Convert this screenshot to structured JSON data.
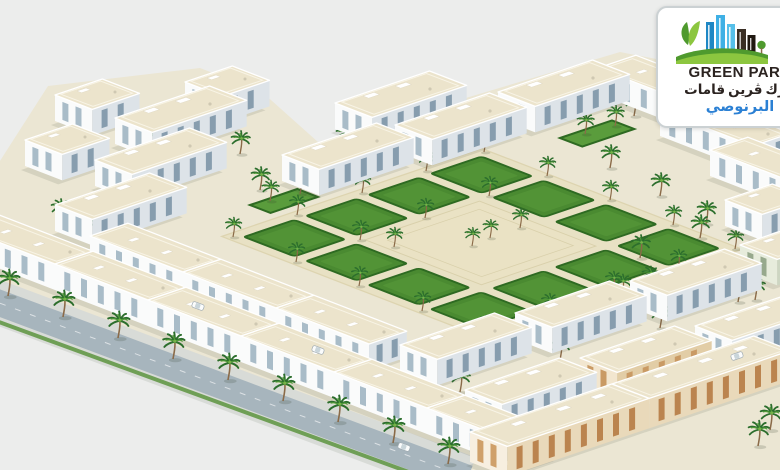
{
  "logo": {
    "brand": "GREEN PARK",
    "arabic_words": [
      "قامات",
      "ڤرين",
      "بارك"
    ],
    "district": "البرنوصي"
  },
  "colors": {
    "bg": "#ecedec",
    "ground": "#ebe6d3",
    "sand": "#e8e1c4",
    "plaza": "#eae2c4",
    "road": "#a7b5bd",
    "sidewalk": "#d8dbd7",
    "verge": "#5d9440",
    "lawn": "#4a8a31",
    "lawn2": "#5a9c3c",
    "hedge": "#2e6a22",
    "roof": "#ece4cc",
    "roof_line": "#f8f4e6",
    "wall_a": "#fafbfb",
    "wall_b": "#dde3e8",
    "glass_a": "#a9bcc8",
    "glass_b": "#879dae",
    "trunk": "#8a6a48",
    "palm": "#2c6e2d",
    "palm2": "#4f9a38",
    "palm3": "#76b24a",
    "beige_a": "#f7efe0",
    "beige_b": "#e9d9ba",
    "beige_ga": "#cfa06a",
    "beige_gb": "#bb844f",
    "green_a": "#e7ecdc",
    "green_b": "#cdd6c2",
    "green_g": "#97a98d",
    "tan_a": "#f2e6cf",
    "tan_b": "#e2cda6",
    "tan_g": "#c99a64",
    "card_border": "#cbd1d3",
    "text_dark": "#2b2320",
    "district_blue": "#2b80d4",
    "logo_blue1": "#56bfe9",
    "logo_blue2": "#1f87c4",
    "logo_blue3": "#3fb0e5",
    "logo_dark1": "#3a2e24",
    "logo_dark2": "#201811",
    "logo_green1": "#8cc63f",
    "logo_green2": "#4f9a2e"
  }
}
